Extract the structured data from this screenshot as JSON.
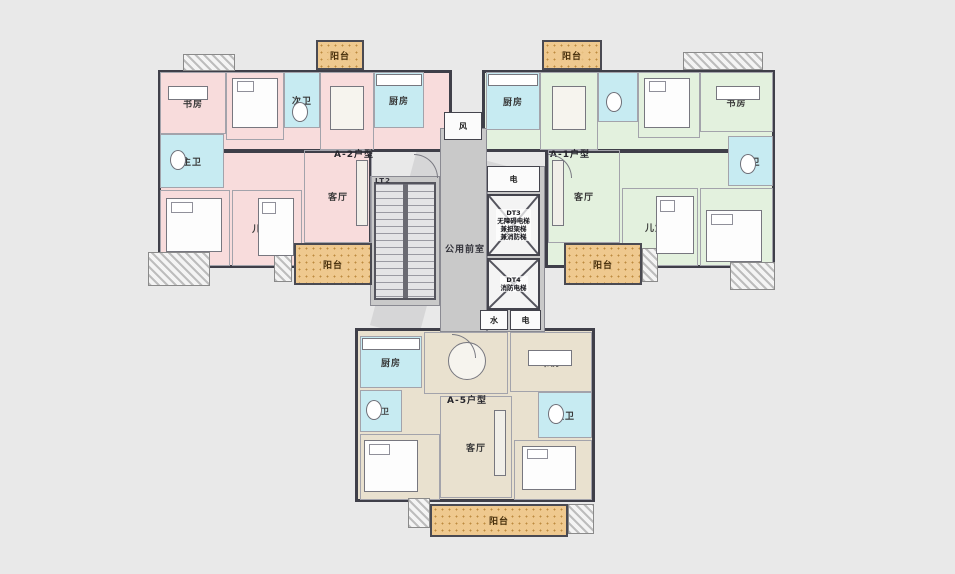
{
  "colors": {
    "background": "#e9e9e9",
    "unit_a2_fill": "#f8dcdc",
    "unit_a1_fill": "#e3f1de",
    "unit_a5_fill": "#e9e1cf",
    "bathroom_fill": "#c7ebf2",
    "balcony_fill": "#efc98f",
    "core_fill": "#c9c9c9",
    "wall": "#3f3f49"
  },
  "units": {
    "a2": {
      "type_label": "A-2户型",
      "rooms": {
        "study": "书房",
        "bedroom": "卧室",
        "bath2": "次卫",
        "dining": "餐厅",
        "kitchen": "厨房",
        "master_bath": "主卫",
        "master_bedroom": "主卧",
        "kids_room": "儿童房",
        "living": "客厅"
      }
    },
    "a1": {
      "type_label": "A-1户型",
      "rooms": {
        "kitchen": "厨房",
        "dining": "餐厅",
        "bedroom": "卧室",
        "study": "书房",
        "master_bath": "主卫",
        "living": "客厅",
        "kids_room": "儿童房",
        "master_bedroom": "主卧"
      }
    },
    "a5": {
      "type_label": "A-5户型",
      "rooms": {
        "kitchen": "厨房",
        "dining": "餐厅",
        "study": "书房",
        "master_bath": "主卫",
        "bath2": "次卫",
        "master_bedroom": "主卧",
        "living": "客厅",
        "kids_room": "儿童房"
      }
    }
  },
  "core": {
    "lobby_label": "公用前室",
    "stair_label": "LT2",
    "elevator_dt3": {
      "id": "DT3",
      "line1": "无障碍电梯",
      "line2": "兼担架梯",
      "line3": "兼消防梯"
    },
    "elevator_dt4": {
      "id": "DT4",
      "line1": "消防电梯"
    },
    "shaft_electric_top": "电",
    "shaft_water": "水",
    "shaft_electric_bottom": "电",
    "shaft_air": "风"
  },
  "balconies": {
    "top_left": "阳台",
    "top_right": "阳台",
    "mid_left": "阳台",
    "mid_right": "阳台",
    "bottom": "阳台"
  }
}
